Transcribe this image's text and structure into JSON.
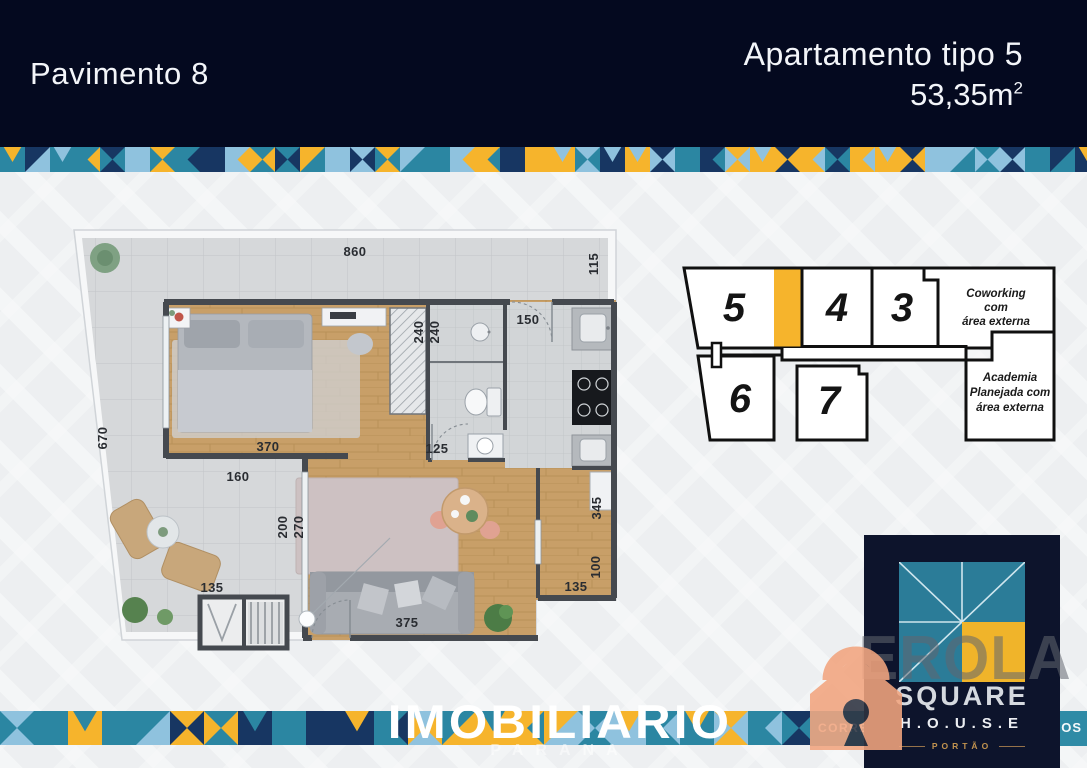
{
  "header": {
    "floor_label": "Pavimento 8",
    "unit_title": "Apartamento tipo 5",
    "area": "53,35m",
    "area_sup": "2"
  },
  "plan": {
    "dims": {
      "d860": "860",
      "d115": "115",
      "d670": "670",
      "d240a": "240",
      "d240b": "240",
      "d150": "150",
      "d125": "125",
      "d370": "370",
      "d160": "160",
      "d200": "200",
      "d270": "270",
      "d135a": "135",
      "d375": "375",
      "d135b": "135",
      "d100": "100",
      "d345": "345"
    }
  },
  "key_plan": {
    "units": [
      "5",
      "4",
      "3",
      "6",
      "7"
    ],
    "coworking_lines": [
      "Coworking",
      "com",
      "área externa"
    ],
    "academia_lines": [
      "Academia",
      "Planejada com",
      "área externa"
    ],
    "highlight_color": "#f6b42c"
  },
  "logo": {
    "name": "SQUARE",
    "spelled": "H.O.U.S.E",
    "city": "PORTÃO"
  },
  "watermark": {
    "brand": "IMOBILIARIO",
    "brand_sub": "PARANA",
    "banner_left": "CORRETORA",
    "banner_right": "OS",
    "letters": "EROLA"
  },
  "colors": {
    "header_bg": "#04091f",
    "mosaic": {
      "teal": "#2b86a2",
      "navy": "#173662",
      "sky": "#8fc2de",
      "yellow": "#f6b42c"
    },
    "logo_card": "#0d142c",
    "logo_teal": "#2b7c98",
    "logo_yellow": "#f0b42a",
    "banner": "#2f8ba6",
    "watermark_orange": "#f2a57f"
  }
}
